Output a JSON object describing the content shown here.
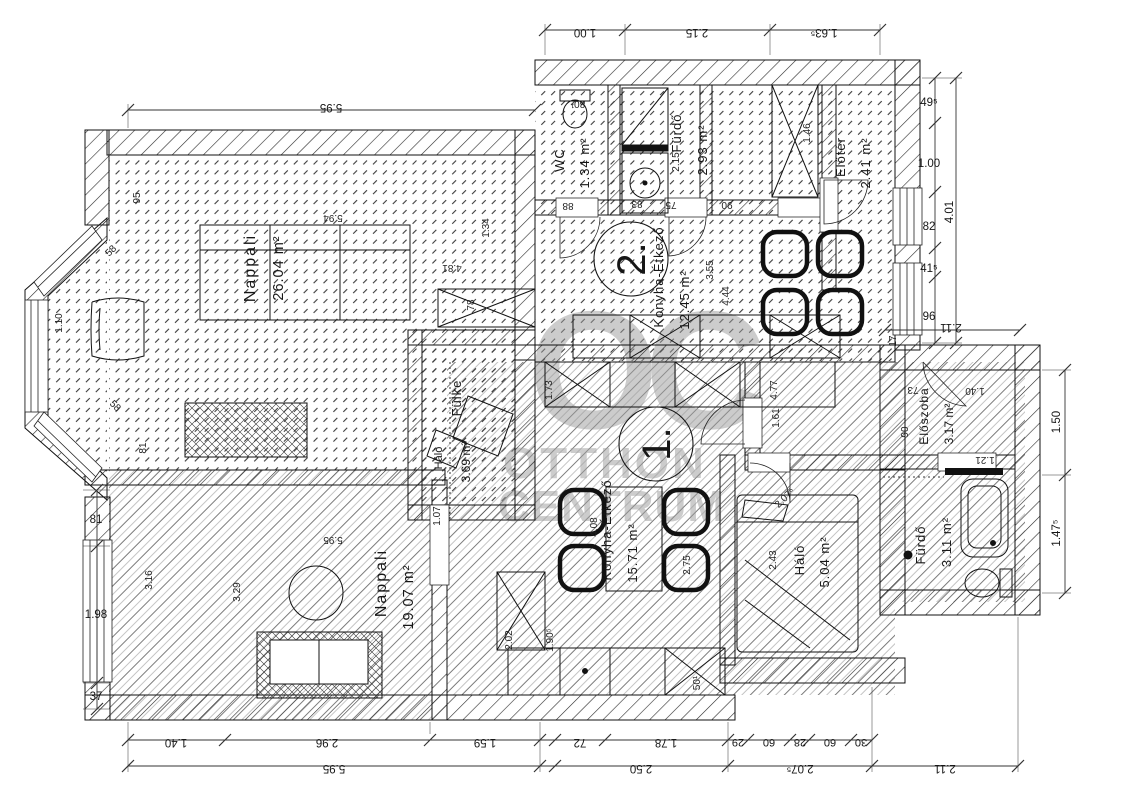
{
  "watermark": {
    "monogram": "OC",
    "line1": "OTTHON",
    "line2": "CENTRUM",
    "color": "#9b9b9b"
  },
  "units": [
    {
      "number": "2.",
      "rooms": [
        {
          "name": "Nappali",
          "area": "26.04 m²"
        },
        {
          "name": "WC",
          "area": "1.34 m²"
        },
        {
          "name": "Fürdő",
          "area": "2.93 m²"
        },
        {
          "name": "Előtér",
          "area": "2.41 m²"
        },
        {
          "name": "Konyha-Étkező",
          "area": "12.45 m²"
        }
      ]
    },
    {
      "number": "1.",
      "rooms": [
        {
          "name": "Nappali",
          "area": "19.07 m²"
        },
        {
          "name": "Konyha-Étkező",
          "area": "15.71 m²"
        },
        {
          "name": "Fülke",
          "sublabel": "Háló",
          "area": "3.69 m²"
        },
        {
          "name": "Háló",
          "area": "5.04 m²"
        },
        {
          "name": "Fürdő",
          "area": "3.11 m²"
        },
        {
          "name": "Előszoba",
          "area": "3.17 m²"
        }
      ]
    }
  ],
  "dims": {
    "top": [
      "1.00",
      "2.15",
      "1.63⁵"
    ],
    "top_inner": "5.95",
    "right": [
      "49⁵",
      "1.00",
      "82",
      "41⁵",
      "96"
    ],
    "right_total": "4.01",
    "right_width": "2.11",
    "right_lower": [
      "1.50",
      "1.47⁵"
    ],
    "bottom_row1": [
      "1.40",
      "2.96",
      "1.59",
      "72",
      "1.78",
      "29",
      "60",
      "28",
      "60",
      "30"
    ],
    "bottom_row2": [
      "5.95",
      "2.50",
      "2.07⁵",
      "2.11"
    ],
    "left": [
      "81",
      "1.98",
      "37"
    ],
    "interior": [
      "5.94",
      "4.81",
      "1.34",
      "78",
      "95",
      "1.10",
      "81",
      "3.16",
      "3.29",
      "5.95",
      "1.07",
      "2.02",
      "1.90⁵",
      "2.75",
      "4.08",
      "1.73",
      "4.77",
      "3.55",
      "4.44",
      "2.15",
      "1.46",
      "2.43",
      "1.61",
      "2.07⁵",
      "17",
      "73",
      "1.40",
      "90",
      "1.21",
      "80¹",
      "88",
      "83",
      "75",
      "90",
      "58",
      "58",
      "50¹"
    ]
  }
}
